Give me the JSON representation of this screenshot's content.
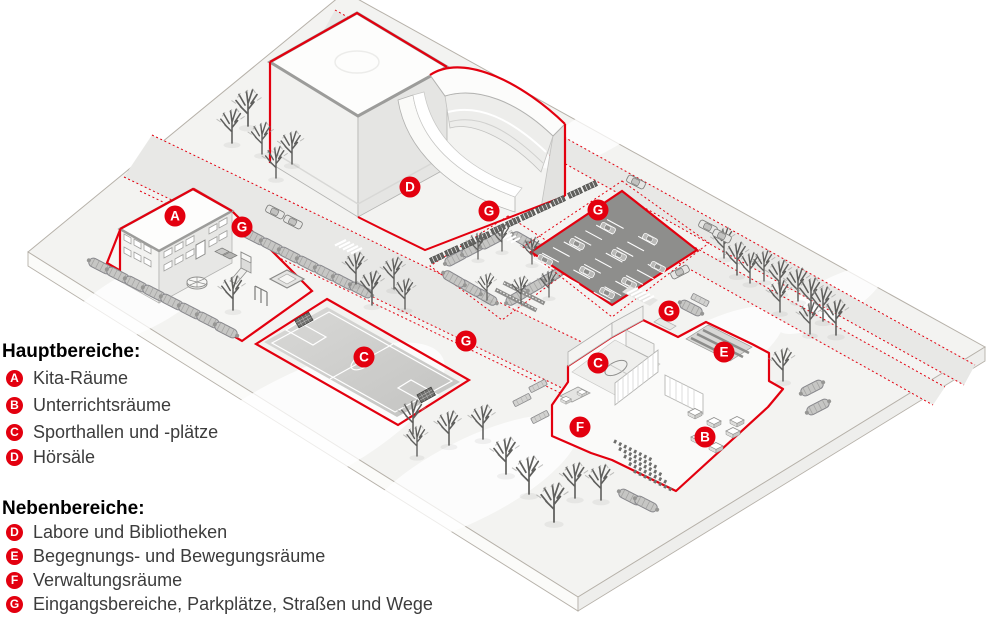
{
  "legend": {
    "sections": [
      {
        "title": "Hauptbereiche:",
        "items": [
          {
            "letter": "A",
            "label": "Kita-Räume"
          },
          {
            "letter": "B",
            "label": "Unterrichtsräume"
          },
          {
            "letter": "C",
            "label": "Sporthallen und -plätze"
          },
          {
            "letter": "D",
            "label": "Hörsäle"
          }
        ]
      },
      {
        "title": "Nebenbereiche:",
        "items": [
          {
            "letter": "D",
            "label": "Labore und Bibliotheken"
          },
          {
            "letter": "E",
            "label": "Begegnungs- und Bewegungsräume"
          },
          {
            "letter": "F",
            "label": "Verwaltungsräume"
          },
          {
            "letter": "G",
            "label": "Eingangsbereiche, Parkplätze, Straßen und Wege"
          }
        ]
      }
    ]
  },
  "map": {
    "accent_red": "#e3000f",
    "badges": [
      {
        "letter": "A",
        "area": "kita-building"
      },
      {
        "letter": "G",
        "area": "kita-entrance"
      },
      {
        "letter": "D",
        "area": "lecture-hall-building"
      },
      {
        "letter": "G",
        "area": "bike-parking"
      },
      {
        "letter": "G",
        "area": "parking-lot"
      },
      {
        "letter": "C",
        "area": "sports-field"
      },
      {
        "letter": "G",
        "area": "central-walkway"
      },
      {
        "letter": "G",
        "area": "school-entrance"
      },
      {
        "letter": "C",
        "area": "sports-hall"
      },
      {
        "letter": "E",
        "area": "meeting-area"
      },
      {
        "letter": "F",
        "area": "administration"
      },
      {
        "letter": "B",
        "area": "classrooms"
      }
    ]
  }
}
